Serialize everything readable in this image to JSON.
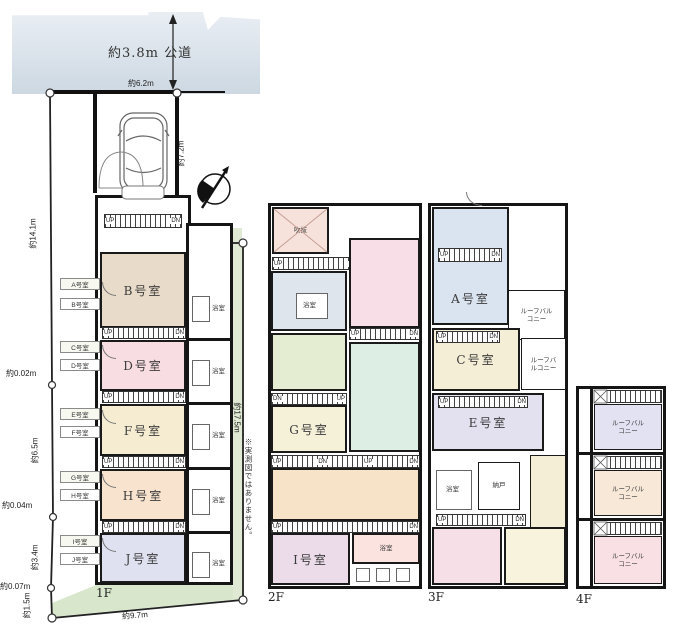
{
  "site": {
    "road": "約3.8m 公道",
    "frontage": "約6.2m",
    "east": "約7.2m",
    "north": "約3.4m",
    "west1": "約14.1m",
    "west2": "約0.02m",
    "west3": "約6.5m",
    "west4": "約0.04m",
    "west5": "約3.4m",
    "west6": "約0.07m",
    "west7": "約1.5m",
    "south": "約9.7m",
    "east_building": "約17.5m",
    "note": "※実測図ではありません。"
  },
  "labels": {
    "up": "UP",
    "dn": "DN",
    "bath": "浴室",
    "storage": "納戸",
    "void_room": "吹抜",
    "roof_balcony": "ルーフバルコニー"
  },
  "f1": {
    "floor": "1F",
    "rooms": {
      "b": "B号室",
      "d": "D号室",
      "f": "F号室",
      "h": "H号室",
      "j": "J号室"
    },
    "entries": [
      "A号室",
      "B号室",
      "C号室",
      "D号室",
      "E号室",
      "F号室",
      "G号室",
      "H号室",
      "I号室",
      "J号室"
    ]
  },
  "f2": {
    "floor": "2F",
    "rooms": {
      "g": "G号室",
      "i": "I号室"
    }
  },
  "f3": {
    "floor": "3F",
    "rooms": {
      "a": "A号室",
      "c": "C号室",
      "e": "E号室"
    }
  },
  "f4": {
    "floor": "4F"
  },
  "palette": {
    "road": "#dbe3ec",
    "yard": "#d8e7cc",
    "room_b": "#e8dbc9",
    "room_d": "#f8dde3",
    "room_f": "#f5ecd2",
    "room_h": "#f8e3cf",
    "room_j": "#dfe1f0",
    "f2_void": "#f6e2da",
    "f2_blue": "#dfe5ec",
    "f2_pink": "#f8dee6",
    "f2_green": "#e4ecd2",
    "f2_mint": "#ddeee4",
    "f2_cream": "#f5f0d8",
    "f2_orange": "#f7e3c8",
    "f2_purple": "#ecdcea",
    "f2_rose": "#fbe4e0",
    "f3_a": "#d9e4f0",
    "f3_c": "#f5eed6",
    "f3_e": "#e3e0f0",
    "f3_pink": "#f6dfe6",
    "f3_cream": "#f8f3dc",
    "f4_1": "#e3e2f2",
    "f4_2": "#f8e8d8",
    "f4_3": "#f8e0e4"
  }
}
